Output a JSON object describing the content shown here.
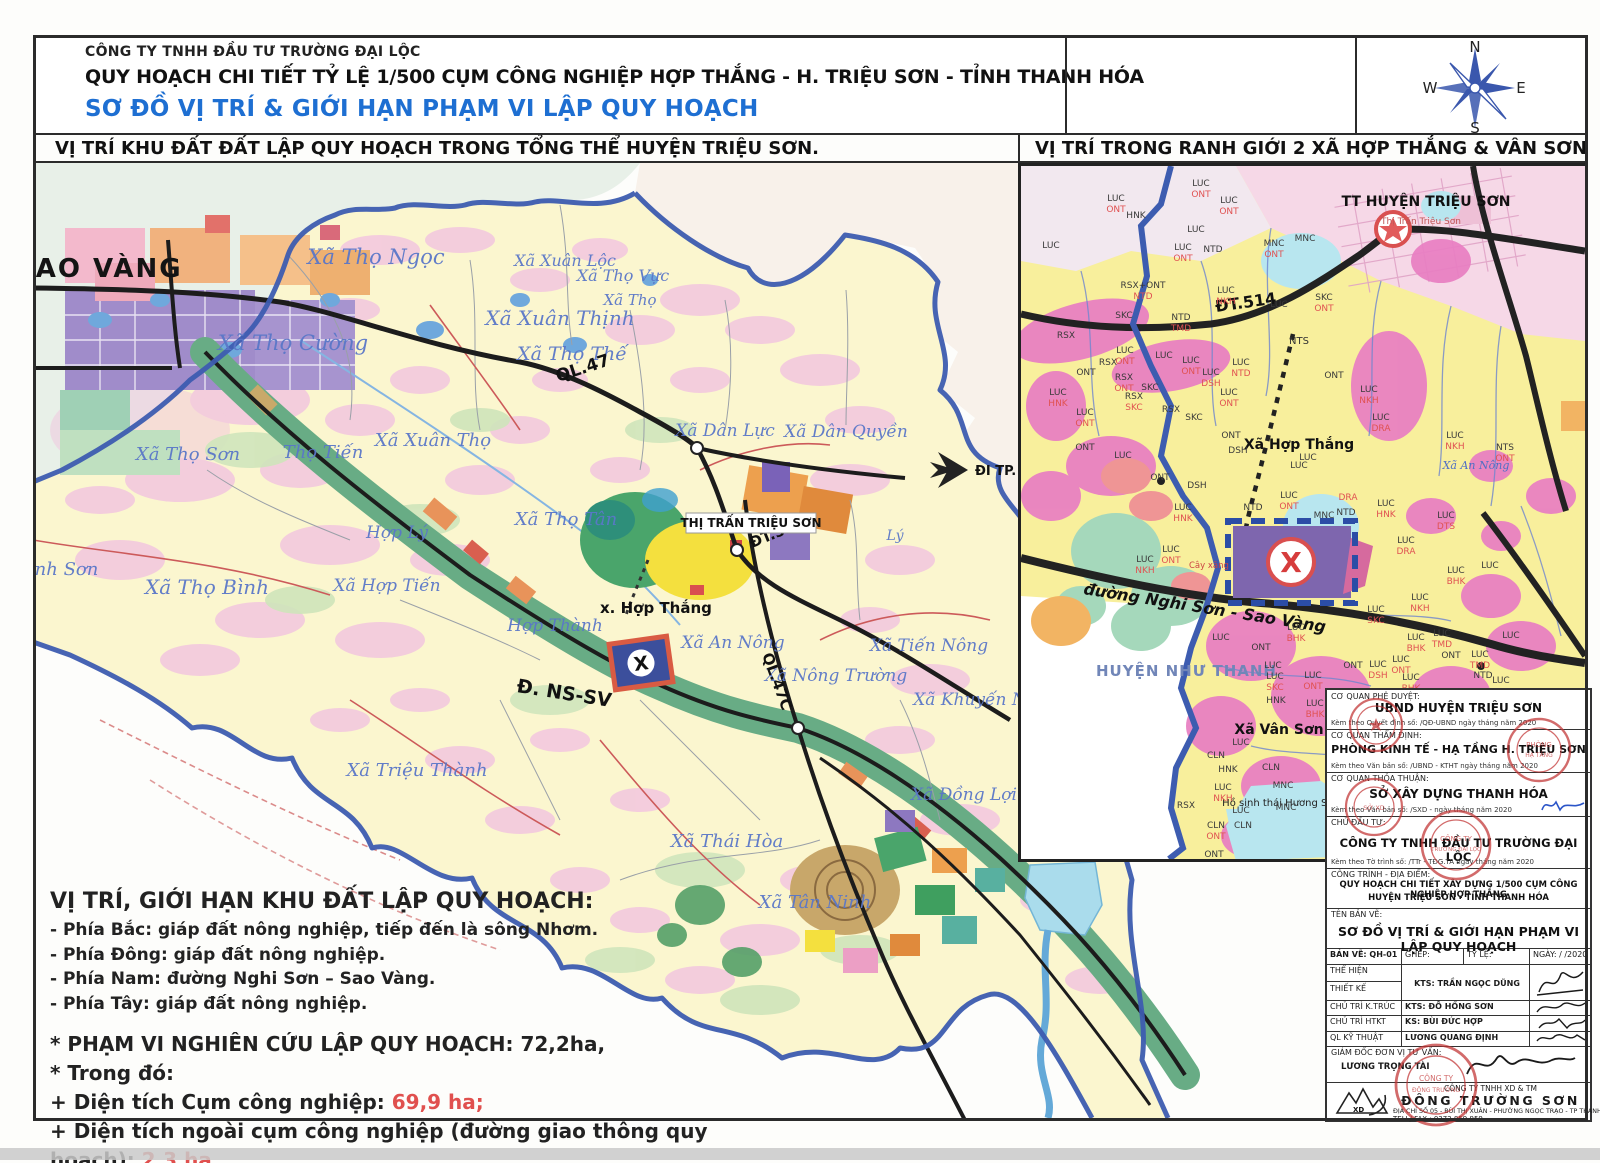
{
  "header": {
    "company": "CÔNG TY TNHH ĐẦU TƯ TRƯỜNG ĐẠI LỘC",
    "title": "QUY HOẠCH CHI TIẾT TỶ LỆ 1/500 CỤM CÔNG NGHIỆP HỢP THẮNG - H. TRIỆU SƠN - TỈNH THANH HÓA",
    "subtitle": "SƠ ĐỒ VỊ TRÍ & GIỚI HẠN PHẠM VI LẬP QUY HOẠCH",
    "section_left": "VỊ TRÍ KHU ĐẤT ĐẤT LẬP QUY HOẠCH TRONG TỔNG THỂ HUYỆN TRIỆU SƠN.",
    "section_right": "VỊ TRÍ TRONG RANH GIỚI 2 XÃ HỢP THẮNG & VÂN SƠN"
  },
  "compass": {
    "n": "N",
    "e": "E",
    "s": "S",
    "w": "W"
  },
  "main_map": {
    "big_label": "SAO VÀNG",
    "town_box": "THỊ TRẤN TRIỆU SƠN",
    "site_label": "x. Hợp Thắng",
    "x_mark": "X",
    "arrow_label": "ĐI TP. TH",
    "roads": {
      "ql47": "QL.47",
      "dt514": "ĐT.514",
      "ql47c": "QL.47C",
      "nssv": "Đ. NS-SV"
    },
    "communes": [
      {
        "t": "Xã Thọ Ngọc",
        "x": 376,
        "y": 264,
        "s": 21
      },
      {
        "t": "Xã Xuân Lộc",
        "x": 565,
        "y": 266,
        "s": 16
      },
      {
        "t": "Xã Thọ Vực",
        "x": 623,
        "y": 281,
        "s": 16
      },
      {
        "t": "Xã Thọ",
        "x": 630,
        "y": 305,
        "s": 15
      },
      {
        "t": "Xã Xuân Thịnh",
        "x": 560,
        "y": 325,
        "s": 20
      },
      {
        "t": "Xã Thọ Thế",
        "x": 572,
        "y": 360,
        "s": 19
      },
      {
        "t": "Xã Thọ Cường",
        "x": 293,
        "y": 350,
        "s": 21
      },
      {
        "t": "Xã Xuân Thọ",
        "x": 433,
        "y": 446,
        "s": 18
      },
      {
        "t": "Xã Thọ Sơn",
        "x": 188,
        "y": 460,
        "s": 18
      },
      {
        "t": "Thọ Tiến",
        "x": 323,
        "y": 458,
        "s": 18
      },
      {
        "t": "Xã Thọ Tân",
        "x": 566,
        "y": 525,
        "s": 18
      },
      {
        "t": "Xã Dân Lực",
        "x": 725,
        "y": 436,
        "s": 17
      },
      {
        "t": "Xã Dân Quyền",
        "x": 846,
        "y": 437,
        "s": 17
      },
      {
        "t": "Lý",
        "x": 895,
        "y": 540,
        "s": 14
      },
      {
        "t": "Bình Sơn",
        "x": 57,
        "y": 575,
        "s": 18
      },
      {
        "t": "Xã Thọ Bình",
        "x": 207,
        "y": 594,
        "s": 20
      },
      {
        "t": "Hợp Lý",
        "x": 397,
        "y": 538,
        "s": 17
      },
      {
        "t": "Xã Hợp Tiến",
        "x": 387,
        "y": 591,
        "s": 17
      },
      {
        "t": "Hợp Thành",
        "x": 555,
        "y": 631,
        "s": 17
      },
      {
        "t": "Xã An Nông",
        "x": 733,
        "y": 648,
        "s": 17
      },
      {
        "t": "Xã Nông Trường",
        "x": 836,
        "y": 681,
        "s": 17
      },
      {
        "t": "Xã Tiến Nông",
        "x": 929,
        "y": 651,
        "s": 17
      },
      {
        "t": "Xã Khuyến Nông",
        "x": 986,
        "y": 705,
        "s": 17
      },
      {
        "t": "Xã Đồng Lợi",
        "x": 964,
        "y": 800,
        "s": 17
      },
      {
        "t": "Xã Thái Hòa",
        "x": 727,
        "y": 847,
        "s": 18
      },
      {
        "t": "Xã Tân Ninh",
        "x": 815,
        "y": 908,
        "s": 18
      },
      {
        "t": "Xã Triệu Thành",
        "x": 417,
        "y": 776,
        "s": 18
      }
    ]
  },
  "inset_map": {
    "tt_label": "TT HUYỆN TRIỆU SƠN",
    "tt_sub": "Thị Trấn Triệu Sơn",
    "road_dt514": "ĐT.514",
    "road_ns_sv": "đường Nghi Sơn - Sao Vàng",
    "nts": "NTS",
    "hop_thang": "Xã Hợp Thắng",
    "hop_thang_code": "LUC",
    "an_nong": "Xã An Nông",
    "nhu_thanh": "HUYỆN NHƯ THANH",
    "van_son": "Xã Vân Sơn",
    "lake": "Hồ sinh thái Hương Sơn",
    "gas": "Cây xăng",
    "x_mark": "X",
    "codes": [
      {
        "t": "LUC",
        "x": 30,
        "y": 82
      },
      {
        "t": "LUC",
        "x": 95,
        "y": 35
      },
      {
        "t": "ONT",
        "x": 95,
        "y": 46,
        "c": "r"
      },
      {
        "t": "LUC",
        "x": 180,
        "y": 20
      },
      {
        "t": "ONT",
        "x": 180,
        "y": 31,
        "c": "r"
      },
      {
        "t": "LUC",
        "x": 208,
        "y": 37
      },
      {
        "t": "ONT",
        "x": 208,
        "y": 48,
        "c": "r"
      },
      {
        "t": "HNK",
        "x": 115,
        "y": 52
      },
      {
        "t": "LUC",
        "x": 175,
        "y": 66
      },
      {
        "t": "LUC",
        "x": 162,
        "y": 84
      },
      {
        "t": "ONT",
        "x": 162,
        "y": 95,
        "c": "r"
      },
      {
        "t": "NTD",
        "x": 192,
        "y": 86
      },
      {
        "t": "MNC",
        "x": 253,
        "y": 80
      },
      {
        "t": "ONT",
        "x": 253,
        "y": 91,
        "c": "r"
      },
      {
        "t": "MNC",
        "x": 284,
        "y": 75
      },
      {
        "t": "RSX+ONT",
        "x": 122,
        "y": 122
      },
      {
        "t": "NTD",
        "x": 122,
        "y": 133,
        "c": "r"
      },
      {
        "t": "LUC",
        "x": 205,
        "y": 127
      },
      {
        "t": "NKH",
        "x": 205,
        "y": 138,
        "c": "r"
      },
      {
        "t": "NTD",
        "x": 160,
        "y": 154
      },
      {
        "t": "TMD",
        "x": 160,
        "y": 165,
        "c": "r"
      },
      {
        "t": "SKC",
        "x": 103,
        "y": 152
      },
      {
        "t": "SKC",
        "x": 303,
        "y": 134
      },
      {
        "t": "ONT",
        "x": 303,
        "y": 145,
        "c": "r"
      },
      {
        "t": "LUC",
        "x": 258,
        "y": 141
      },
      {
        "t": "RSX",
        "x": 45,
        "y": 172
      },
      {
        "t": "RSX",
        "x": 87,
        "y": 199
      },
      {
        "t": "LUC",
        "x": 104,
        "y": 187
      },
      {
        "t": "ONT",
        "x": 104,
        "y": 198,
        "c": "r"
      },
      {
        "t": "LUC",
        "x": 143,
        "y": 192
      },
      {
        "t": "LUC",
        "x": 170,
        "y": 197
      },
      {
        "t": "ONT",
        "x": 170,
        "y": 208,
        "c": "r"
      },
      {
        "t": "LUC",
        "x": 220,
        "y": 199
      },
      {
        "t": "NTD",
        "x": 220,
        "y": 210,
        "c": "r"
      },
      {
        "t": "LUC",
        "x": 190,
        "y": 209
      },
      {
        "t": "DSH",
        "x": 190,
        "y": 220,
        "c": "r"
      },
      {
        "t": "ONT",
        "x": 65,
        "y": 209
      },
      {
        "t": "RSX",
        "x": 103,
        "y": 214
      },
      {
        "t": "ONT",
        "x": 103,
        "y": 225,
        "c": "r"
      },
      {
        "t": "SKC",
        "x": 129,
        "y": 224
      },
      {
        "t": "RSX",
        "x": 113,
        "y": 233
      },
      {
        "t": "SKC",
        "x": 113,
        "y": 244,
        "c": "r"
      },
      {
        "t": "LUC",
        "x": 208,
        "y": 229
      },
      {
        "t": "ONT",
        "x": 208,
        "y": 240,
        "c": "r"
      },
      {
        "t": "ONT",
        "x": 313,
        "y": 212
      },
      {
        "t": "LUC",
        "x": 37,
        "y": 229
      },
      {
        "t": "HNK",
        "x": 37,
        "y": 240,
        "c": "r"
      },
      {
        "t": "LUC",
        "x": 64,
        "y": 249
      },
      {
        "t": "ONT",
        "x": 64,
        "y": 260,
        "c": "r"
      },
      {
        "t": "RSX",
        "x": 150,
        "y": 246
      },
      {
        "t": "SKC",
        "x": 173,
        "y": 254
      },
      {
        "t": "LUC",
        "x": 348,
        "y": 226
      },
      {
        "t": "NKH",
        "x": 348,
        "y": 237,
        "c": "r"
      },
      {
        "t": "LUC",
        "x": 360,
        "y": 254
      },
      {
        "t": "DRA",
        "x": 360,
        "y": 265,
        "c": "r"
      },
      {
        "t": "ONT",
        "x": 64,
        "y": 284
      },
      {
        "t": "LUC",
        "x": 102,
        "y": 292
      },
      {
        "t": "ONT",
        "x": 139,
        "y": 314
      },
      {
        "t": "DSH",
        "x": 176,
        "y": 322
      },
      {
        "t": "ONT",
        "x": 210,
        "y": 272
      },
      {
        "t": "DSH",
        "x": 217,
        "y": 287
      },
      {
        "t": "LUC",
        "x": 287,
        "y": 294
      },
      {
        "t": "NTS",
        "x": 484,
        "y": 284
      },
      {
        "t": "ONT",
        "x": 484,
        "y": 295,
        "c": "r"
      },
      {
        "t": "LUC",
        "x": 434,
        "y": 272
      },
      {
        "t": "NKH",
        "x": 434,
        "y": 283,
        "c": "r"
      },
      {
        "t": "LUC",
        "x": 162,
        "y": 344
      },
      {
        "t": "HNK",
        "x": 162,
        "y": 355,
        "c": "r"
      },
      {
        "t": "NTD",
        "x": 232,
        "y": 344
      },
      {
        "t": "LUC",
        "x": 268,
        "y": 332
      },
      {
        "t": "ONT",
        "x": 268,
        "y": 343,
        "c": "r"
      },
      {
        "t": "DRA",
        "x": 327,
        "y": 334,
        "c": "r"
      },
      {
        "t": "MNC",
        "x": 303,
        "y": 352
      },
      {
        "t": "NTD",
        "x": 325,
        "y": 349
      },
      {
        "t": "LUC",
        "x": 365,
        "y": 340
      },
      {
        "t": "HNK",
        "x": 365,
        "y": 351,
        "c": "r"
      },
      {
        "t": "LUC",
        "x": 425,
        "y": 352
      },
      {
        "t": "DTS",
        "x": 425,
        "y": 363,
        "c": "r"
      },
      {
        "t": "LUC",
        "x": 385,
        "y": 377
      },
      {
        "t": "DRA",
        "x": 385,
        "y": 388,
        "c": "r"
      },
      {
        "t": "LUC",
        "x": 150,
        "y": 386
      },
      {
        "t": "ONT",
        "x": 150,
        "y": 397,
        "c": "r"
      },
      {
        "t": "LUC",
        "x": 124,
        "y": 396
      },
      {
        "t": "NKH",
        "x": 124,
        "y": 407,
        "c": "r"
      },
      {
        "t": "LUC",
        "x": 435,
        "y": 407
      },
      {
        "t": "BHK",
        "x": 435,
        "y": 418,
        "c": "r"
      },
      {
        "t": "LUC",
        "x": 469,
        "y": 402
      },
      {
        "t": "LUC",
        "x": 399,
        "y": 434
      },
      {
        "t": "NKH",
        "x": 399,
        "y": 445,
        "c": "r"
      },
      {
        "t": "LUC",
        "x": 200,
        "y": 474
      },
      {
        "t": "ONT",
        "x": 240,
        "y": 484
      },
      {
        "t": "LUC",
        "x": 275,
        "y": 464
      },
      {
        "t": "BHK",
        "x": 275,
        "y": 475,
        "c": "r"
      },
      {
        "t": "LUC",
        "x": 355,
        "y": 446
      },
      {
        "t": "SKC",
        "x": 355,
        "y": 457,
        "c": "r"
      },
      {
        "t": "LUC",
        "x": 395,
        "y": 474
      },
      {
        "t": "BHK",
        "x": 395,
        "y": 485,
        "c": "r"
      },
      {
        "t": "LUC",
        "x": 421,
        "y": 470
      },
      {
        "t": "TMD",
        "x": 421,
        "y": 481,
        "c": "r"
      },
      {
        "t": "ONT",
        "x": 430,
        "y": 492
      },
      {
        "t": "LUC",
        "x": 459,
        "y": 491
      },
      {
        "t": "TMD",
        "x": 459,
        "y": 502,
        "c": "r"
      },
      {
        "t": "NTD",
        "x": 462,
        "y": 512
      },
      {
        "t": "LUC",
        "x": 490,
        "y": 472
      },
      {
        "t": "LUC",
        "x": 480,
        "y": 517
      },
      {
        "t": "ONT",
        "x": 332,
        "y": 502
      },
      {
        "t": "LUC",
        "x": 357,
        "y": 501
      },
      {
        "t": "DSH",
        "x": 357,
        "y": 512,
        "c": "r"
      },
      {
        "t": "LUC",
        "x": 380,
        "y": 496
      },
      {
        "t": "ONT",
        "x": 380,
        "y": 507,
        "c": "r"
      },
      {
        "t": "LUC",
        "x": 390,
        "y": 514
      },
      {
        "t": "BHK",
        "x": 390,
        "y": 525,
        "c": "r"
      },
      {
        "t": "LUC",
        "x": 252,
        "y": 502
      },
      {
        "t": "LUC",
        "x": 254,
        "y": 513
      },
      {
        "t": "SKC",
        "x": 254,
        "y": 524,
        "c": "r"
      },
      {
        "t": "LUC",
        "x": 292,
        "y": 512
      },
      {
        "t": "ONT",
        "x": 292,
        "y": 523,
        "c": "r"
      },
      {
        "t": "HNK",
        "x": 255,
        "y": 537
      },
      {
        "t": "LUC",
        "x": 294,
        "y": 540
      },
      {
        "t": "BHK",
        "x": 294,
        "y": 551,
        "c": "r"
      },
      {
        "t": "HNK",
        "x": 372,
        "y": 531
      },
      {
        "t": "NTD",
        "x": 420,
        "y": 529
      },
      {
        "t": "LUC",
        "x": 220,
        "y": 579
      },
      {
        "t": "CLN",
        "x": 195,
        "y": 592
      },
      {
        "t": "HNK",
        "x": 207,
        "y": 606
      },
      {
        "t": "CLN",
        "x": 250,
        "y": 604
      },
      {
        "t": "MNC",
        "x": 262,
        "y": 622
      },
      {
        "t": "LUC",
        "x": 202,
        "y": 624
      },
      {
        "t": "NKH",
        "x": 202,
        "y": 635,
        "c": "r"
      },
      {
        "t": "RSX",
        "x": 165,
        "y": 642
      },
      {
        "t": "LUC",
        "x": 220,
        "y": 647
      },
      {
        "t": "MNC",
        "x": 265,
        "y": 644
      },
      {
        "t": "CLN",
        "x": 195,
        "y": 662
      },
      {
        "t": "ONT",
        "x": 195,
        "y": 673,
        "c": "r"
      },
      {
        "t": "CLN",
        "x": 222,
        "y": 662
      },
      {
        "t": "ONT",
        "x": 193,
        "y": 691
      }
    ]
  },
  "notes": {
    "title": "VỊ TRÍ, GIỚI HẠN KHU ĐẤT LẬP QUY HOẠCH:",
    "lines": [
      "- Phía Bắc: giáp đất nông nghiệp, tiếp đến là sông Nhơm.",
      "- Phía Đông: giáp đất nông nghiệp.",
      "- Phía Nam: đường Nghi Sơn – Sao Vàng.",
      "- Phía Tây:  giáp đất nông nghiệp."
    ],
    "scope": "* PHẠM VI NGHIÊN CỨU LẬP QUY HOẠCH: 72,2ha,",
    "in_which": "* Trong đó:",
    "area1_label": " + Diện tích Cụm công nghiệp: ",
    "area1_value": "69,9 ha;",
    "area2_label": " + Diện tích ngoài cụm công nghiệp (đường giao thông quy hoạch): ",
    "area2_value": "2,3 ha."
  },
  "title_block": {
    "rows": [
      {
        "label": "CƠ QUAN PHÊ DUYỆT:",
        "name": "UBND HUYỆN TRIỆU SƠN",
        "note": "Kèm theo Quyết định số:          /QĐ-UBND   ngày       tháng       năm 2020"
      },
      {
        "label": "CƠ QUAN THẨM ĐỊNH:",
        "name": "PHÒNG KINH TẾ - HẠ TẦNG H. TRIỆU SƠN",
        "note": "Kèm theo Văn bản số:          /UBND - KTHT   ngày       tháng       năm 2020"
      },
      {
        "label": "CƠ QUAN THỎA THUẬN:",
        "name": "SỞ XÂY DỰNG THANH HÓA",
        "note": "Kèm theo Văn bản số:          /SXD -        ngày       tháng       năm 2020"
      },
      {
        "label": "CHỦ ĐẦU TƯ:",
        "name": "CÔNG TY TNHH ĐẦU TƯ TRƯỜNG ĐẠI LỘC",
        "note": "Kèm theo Tờ trình số:          /TTr - TĐG.TA   ngày       tháng       năm 2020"
      }
    ],
    "project_label": "CÔNG TRÌNH - ĐỊA ĐIỂM:",
    "project_line1": "QUY HOẠCH CHI TIẾT XÂY DỰNG 1/500 CỤM CÔNG NGHIỆP HỢP THẮNG",
    "project_line2": "HUYỆN TRIỆU SƠN - TỈNH THANH HÓA",
    "drawing_label": "TÊN BẢN VẼ:",
    "drawing_name": "SƠ ĐỒ VỊ TRÍ & GIỚI HẠN PHẠM VI LẬP QUY HOẠCH",
    "meta": {
      "sheet": "BẢN VẼ: QH-01",
      "merge": "GHÉP:",
      "scale": "TỶ LỆ:",
      "date": "NGÀY:    /    /2020"
    },
    "staff": [
      {
        "role": "THỂ HIỆN",
        "person": "KTS: TRẦN NGỌC DŨNG"
      },
      {
        "role": "THIẾT KẾ",
        "person": ""
      },
      {
        "role": "CHỦ TRÌ K.TRÚC",
        "person": "KTS: ĐỖ HỒNG SƠN"
      },
      {
        "role": "CHỦ TRÌ HTKT",
        "person": "KS: BÙI ĐỨC HỢP"
      },
      {
        "role": "QL KỸ THUẬT",
        "person": "LƯƠNG QUANG ĐỊNH"
      }
    ],
    "director_label": "GIÁM ĐỐC ĐƠN VỊ TƯ VẤN:",
    "director_name": "LƯƠNG TRỌNG TÀI",
    "firm_type": "CÔNG TY TNHH XD & TM",
    "firm_name": "ĐÔNG TRƯỜNG SƠN",
    "firm_addr": "ĐỊA CHỈ SỐ 05 - BÙI THỊ XUÂN - PHƯỜNG NGỌC TRẠO - TP THANH HÓA",
    "firm_tel": "TELL/ FAX : 0372.859.959"
  },
  "colors": {
    "accent_blue": "#1e6fd2",
    "boundary_blue": "#3d5cb0",
    "district_yellow": "#fbf6cf",
    "pink": "#f2c3e0",
    "magenta": "#e87ec2",
    "corridor_green": "#68ac85",
    "site_purple": "#7e66ae",
    "stamp_red": "#c23333",
    "value_red": "#e0504e"
  }
}
